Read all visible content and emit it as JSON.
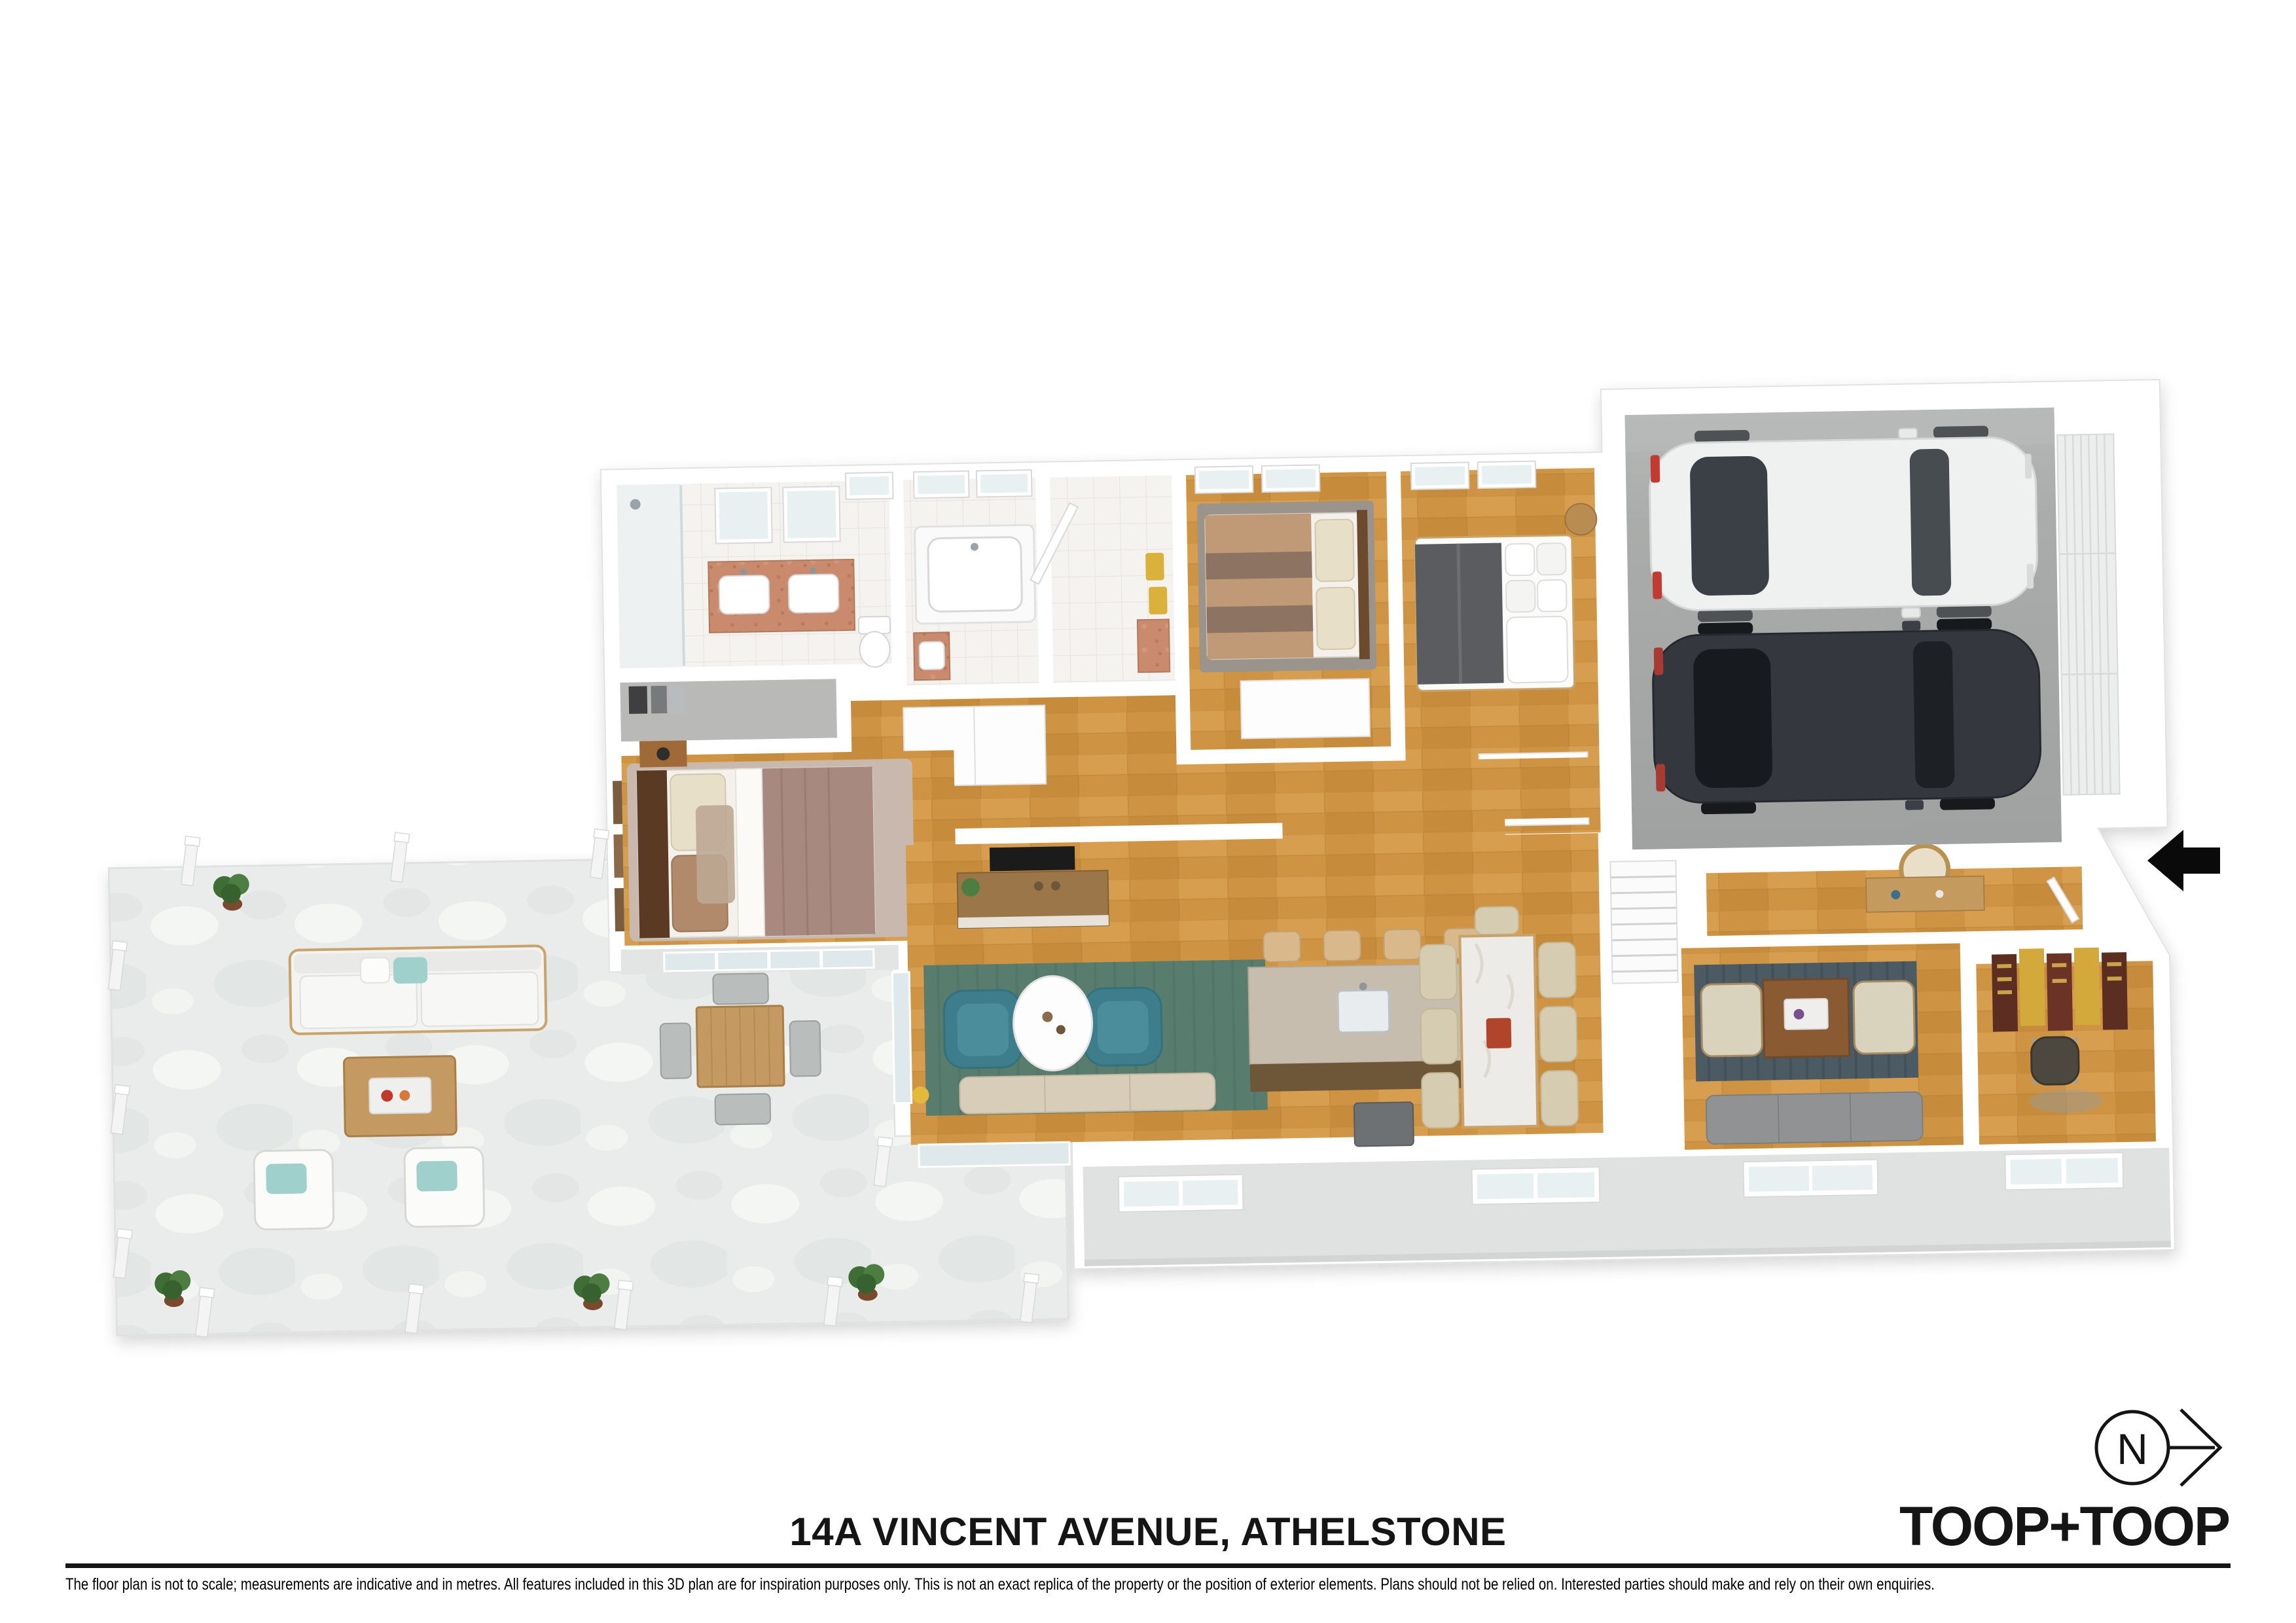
{
  "footer": {
    "title": "14A VINCENT AVENUE, ATHELSTONE",
    "brand": "TOOP+TOOP",
    "disclaimer": "The floor plan is not to scale; measurements are indicative and in metres. All features included in this 3D plan are for inspiration purposes only. This is not an exact replica of the property or the position of exterior elements. Plans should not be relied on. Interested parties should make and rely on their own enquiries."
  },
  "compass": {
    "label": "N"
  },
  "icons": {
    "entry_arrow": "left-arrow",
    "compass": "north-arrow-circle"
  },
  "colors": {
    "ink": "#151515",
    "background": "#ffffff",
    "wall": "#ffffff",
    "exterior_wall_face": "#e0e2e1",
    "wood_floor": "#cf9443",
    "tile_floor": "#f5f3f0",
    "garage_floor": "#a8aaa9",
    "patio_stone": "#e9ecea",
    "accent_teal": "#3e7e8c",
    "rug_living": "#587c6e",
    "rug_lounge": "#4b5a63",
    "vanity_terracotta": "#c98a6d",
    "car_white": "#eff0f0",
    "car_dark": "#34383e"
  }
}
